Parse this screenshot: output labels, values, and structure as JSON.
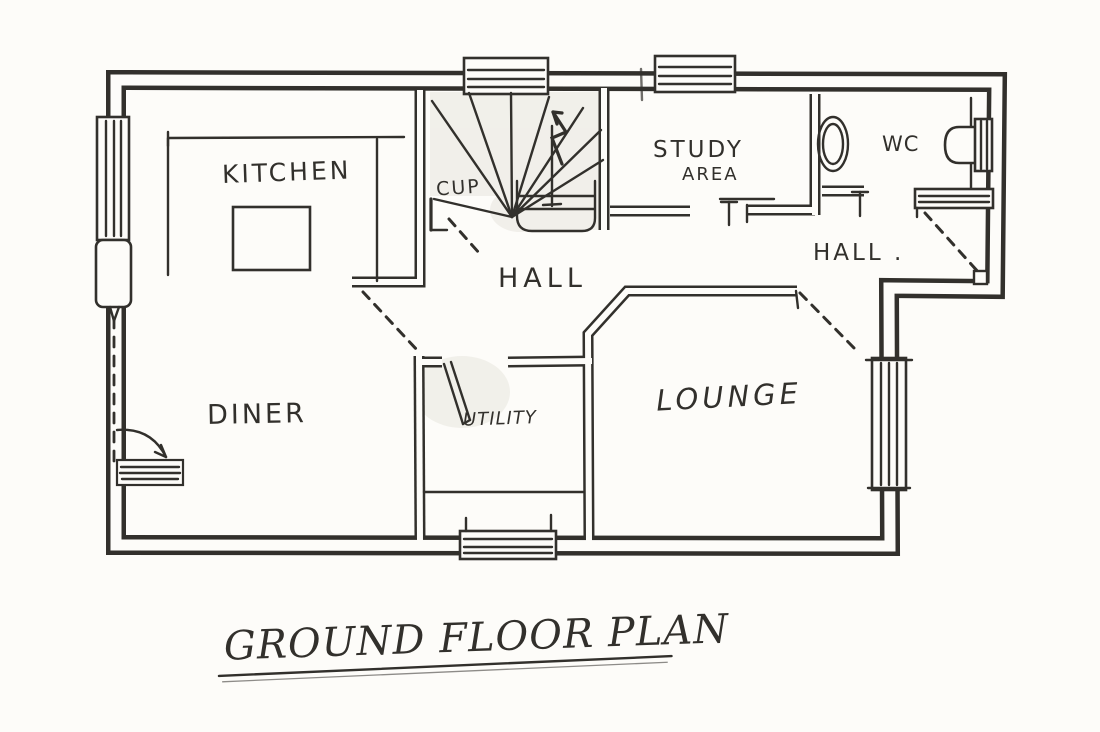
{
  "title": {
    "text": "GROUND FLOOR PLAN"
  },
  "rooms": {
    "kitchen": "KITCHEN",
    "cup": "CUP",
    "study_line1": "STUDY",
    "study_line2": "AREA",
    "wc": "WC",
    "hall_center": "HALL",
    "hall_right": "HALL .",
    "lounge": "LOUNGE",
    "diner": "DINER",
    "utility": "UTILITY"
  },
  "colors": {
    "ink": "#32302c",
    "paper": "#fdfcf9",
    "shade": "#e8e5df"
  }
}
